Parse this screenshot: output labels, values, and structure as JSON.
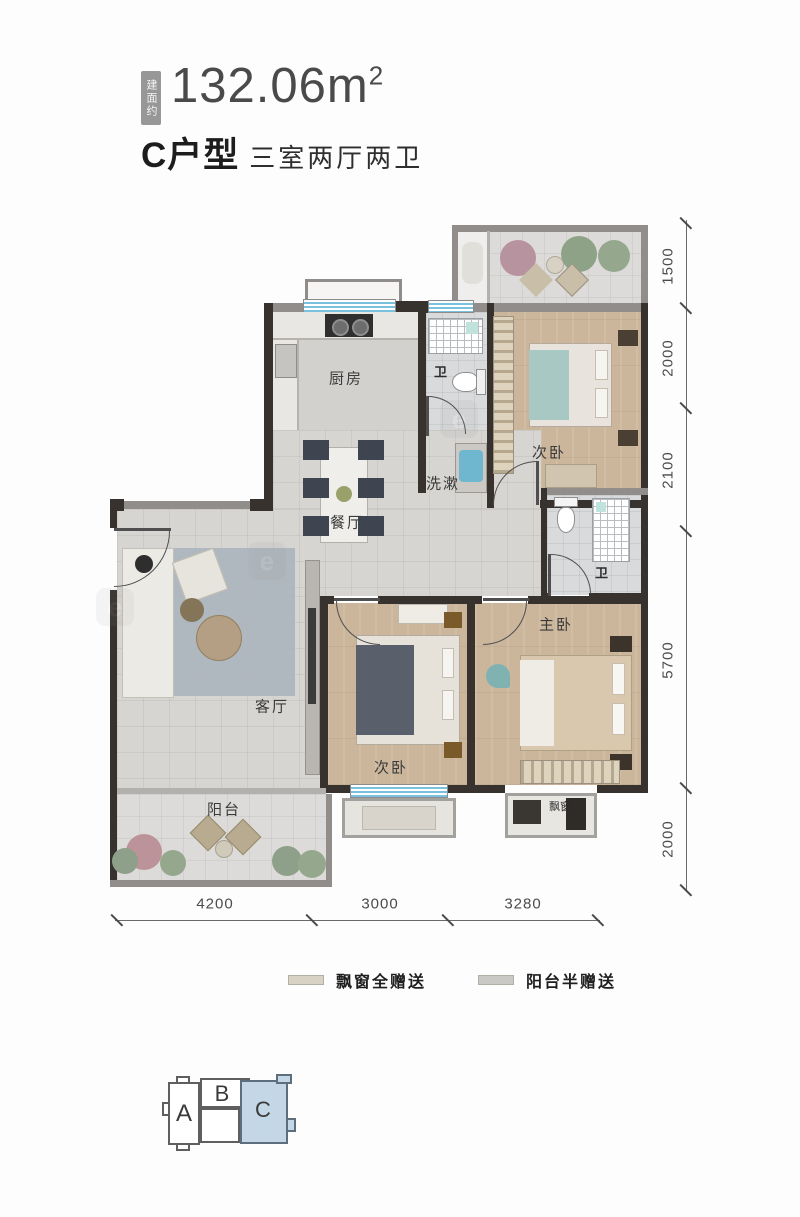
{
  "header": {
    "area_badge": "建面约",
    "area_value": "132.06",
    "area_unit": "m",
    "area_sup": "2",
    "unit_type": "C户型",
    "layout_desc": "三室两厅两卫"
  },
  "rooms": {
    "kitchen": "厨房",
    "bath_top": "卫",
    "bedroom_top": "次卧",
    "washroom": "洗漱",
    "dining": "餐厅",
    "bath_ensuite": "卫",
    "living": "客厅",
    "bedroom_mid": "次卧",
    "master": "主卧",
    "balcony": "阳台",
    "bay_window": "飘窗"
  },
  "dims": {
    "right": [
      "1500",
      "2000",
      "2100",
      "5700",
      "2000"
    ],
    "bottom": [
      "4200",
      "3000",
      "3280"
    ]
  },
  "legend": {
    "items": [
      {
        "label": "飘窗全赠送",
        "swatch": "#d8d2c4"
      },
      {
        "label": "阳台半赠送",
        "swatch": "#cbc9c5"
      }
    ]
  },
  "keyplan": {
    "units": [
      {
        "label": "A",
        "highlighted": false
      },
      {
        "label": "B",
        "highlighted": false
      },
      {
        "label": "C",
        "highlighted": true
      }
    ],
    "highlight_color": "#c3d7e6"
  },
  "watermark": "e"
}
